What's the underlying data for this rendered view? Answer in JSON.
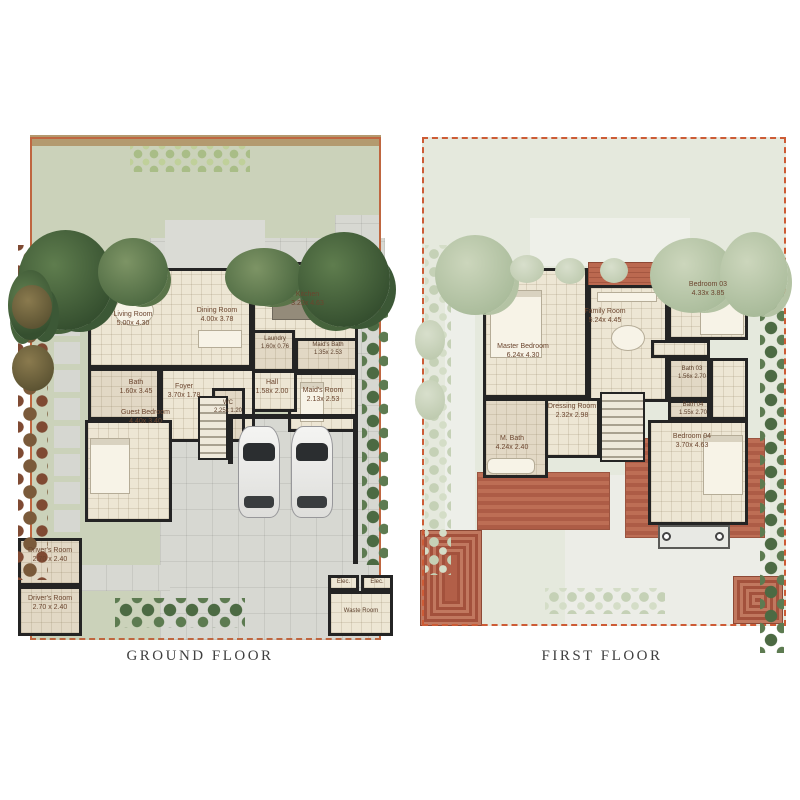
{
  "captions": {
    "ground": "GROUND FLOOR",
    "first": "FIRST FLOOR"
  },
  "colors": {
    "boundary": "#bf6640",
    "wall": "#242424",
    "garden": "#cbd2ba",
    "roof": "#b25f48",
    "label_text": "#6b452e"
  },
  "ground_floor": {
    "living_room": {
      "name": "Living Room",
      "dims": "5.00x 4.30"
    },
    "dining_room": {
      "name": "Dining Room",
      "dims": "4.00x 3.78"
    },
    "kitchen": {
      "name": "Kitchen",
      "dims": "3.23x 4.63"
    },
    "laundry": {
      "name": "Laundry",
      "dims": "1.60x 0.76"
    },
    "maids_bath": {
      "name": "Maid's Bath",
      "dims": "1.35x 2.53"
    },
    "maids_room": {
      "name": "Maid's Room",
      "dims": "2.13x 2.53"
    },
    "hall": {
      "name": "Hall",
      "dims": "1.58x 2.00"
    },
    "wc": {
      "name": "WC",
      "dims": "2.25x 1.20"
    },
    "bath": {
      "name": "Bath",
      "dims": "1.60x 3.45"
    },
    "foyer": {
      "name": "Foyer",
      "dims": "3.70x 1.78"
    },
    "guest_bedroom": {
      "name": "Guest Bedroom",
      "dims": "4.40x 3.40"
    },
    "drivers_room_1": {
      "name": "Driver's Room",
      "dims": "2.70 x 2.40"
    },
    "drivers_room_2": {
      "name": "Driver's Room",
      "dims": "2.70 x 2.40"
    },
    "elec_1": {
      "name": "Elec."
    },
    "elec_2": {
      "name": "Elec."
    },
    "waste_room": {
      "name": "Waste Room"
    }
  },
  "first_floor": {
    "master_bedroom": {
      "name": "Master Bedroom",
      "dims": "6.24x 4.30"
    },
    "family_room": {
      "name": "Family Room",
      "dims": "5.24x 4.45"
    },
    "bedroom_03": {
      "name": "Bedroom 03",
      "dims": "4.33x 3.85"
    },
    "bath_03": {
      "name": "Bath 03",
      "dims": "1.56x 2.70"
    },
    "bath_04": {
      "name": "Bath 04",
      "dims": "1.55x 2.70"
    },
    "bedroom_04": {
      "name": "Bedroom 04",
      "dims": "3.70x 4.63"
    },
    "dressing_room": {
      "name": "Dressing Room",
      "dims": "2.32x 2.98"
    },
    "m_bath": {
      "name": "M. Bath",
      "dims": "4.24x 2.40"
    }
  }
}
